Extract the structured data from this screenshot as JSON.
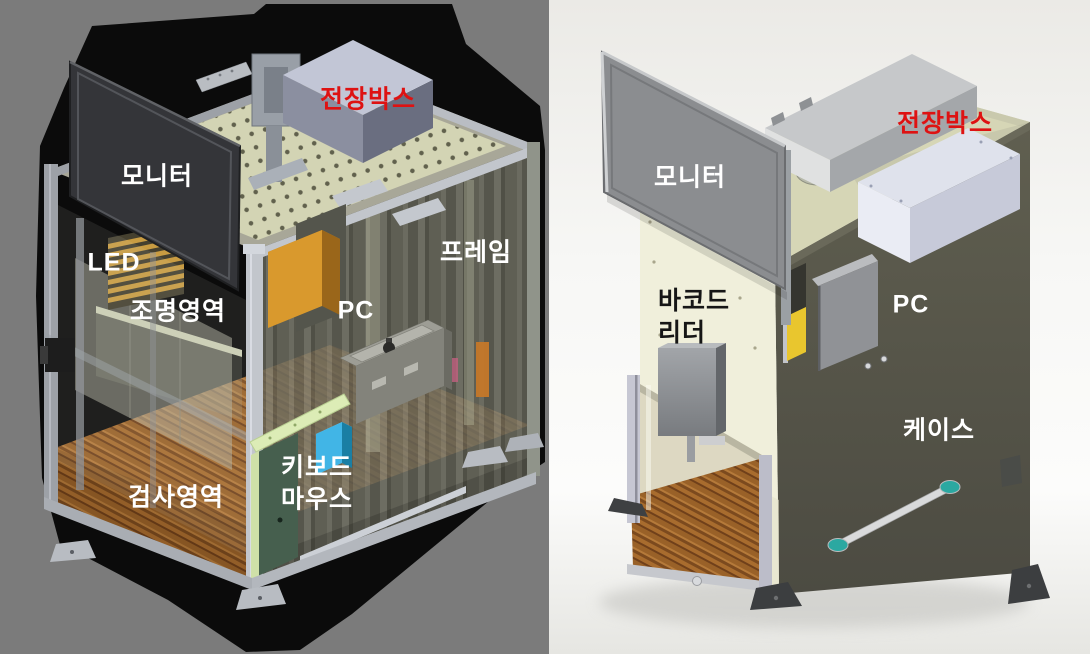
{
  "panels": {
    "left": {
      "background_color": "#7b7b7b",
      "labels": {
        "electrical_box": {
          "text": "전장박스",
          "color": "#de1212"
        },
        "monitor": {
          "text": "모니터",
          "color": "#ffffff"
        },
        "led": {
          "text": "LED",
          "color": "#ffffff"
        },
        "lighting_area": {
          "text": "조명영역",
          "color": "#ffffff"
        },
        "pc": {
          "text": "PC",
          "color": "#ffffff"
        },
        "frame": {
          "text": "프레임",
          "color": "#ffffff"
        },
        "inspection_area": {
          "text": "검사영역",
          "color": "#ffffff"
        },
        "keyboard_mouse": {
          "text": "키보드\n마우스",
          "color": "#ffffff"
        }
      }
    },
    "right": {
      "background_color": "#f0efec",
      "labels": {
        "monitor": {
          "text": "모니터",
          "color": "#ffffff"
        },
        "electrical_box": {
          "text": "전장박스",
          "color": "#de1212"
        },
        "barcode_reader": {
          "text": "바코드\n리더",
          "color": "#161616"
        },
        "pc": {
          "text": "PC",
          "color": "#ffffff"
        },
        "case": {
          "text": "케이스",
          "color": "#ffffff"
        }
      }
    }
  },
  "palette": {
    "accent_red": "#de1212",
    "wood_floor": "#99612a",
    "cream_panel": "#f0efdb",
    "olive_case": "#57564a",
    "frame_aluminum": "#b9bdc3"
  }
}
